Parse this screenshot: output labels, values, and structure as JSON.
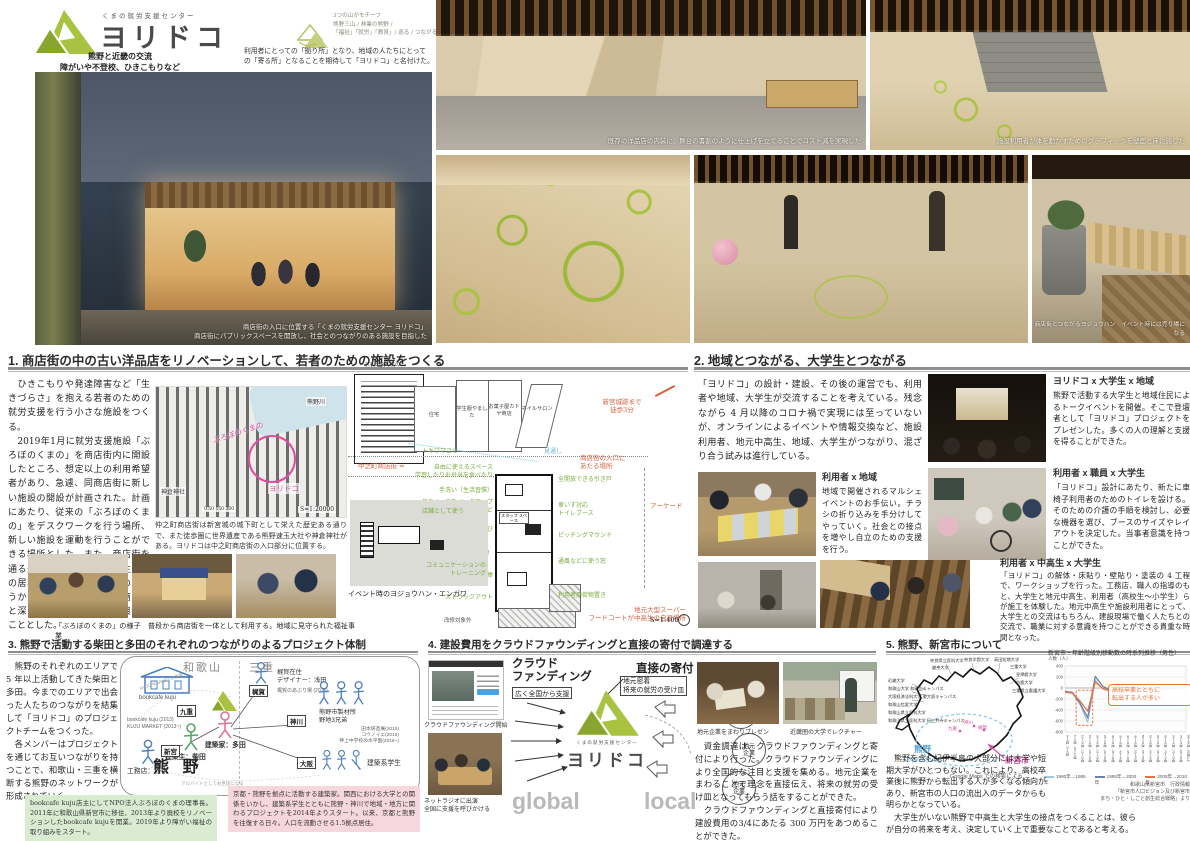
{
  "header": {
    "brand_small": "くまの就労支援センター",
    "brand_title": "ヨリドコ",
    "tagline1": "熊野と近畿の交流",
    "tagline2": "障がいや不登校、ひきこもりなど",
    "tagline3": "“困り感”を抱える若者を支援する場をつくる",
    "motif_title": "3つの山がモチーフ",
    "motif_line1": "熊野三山 / 林業の熊野 /",
    "motif_line2": "「福祉」「就労」「教育」/ 巡る / つながる /",
    "naming_line1": "利用者にとっての「拠り所」となり、地域の人たちにとって",
    "naming_line2": "の「寄る所」となることを期待して「ヨリドコ」と名付けた。"
  },
  "photos": {
    "facade_caption1": "商店街の入口に位置する「くまの就労支援センター ヨリドコ」",
    "facade_caption2": "商店街にパブリックスペースを開放し、社会とのつながりのある施設を目指した",
    "top1_caption": "既存の洋品店の内装に、舞台の書割のように仕上げを立てることでコスト減を実現した",
    "top2_caption": "施設利用者が体を動かすためのグラフィックを壁面と床に施した",
    "row2_caption": "商店街とつながるヨジョウハン　イベント時には売り場になる"
  },
  "section1": {
    "title": "1. 商店街の中の古い洋品店をリノベーションして、若者のための施設をつくる",
    "p1": "　ひきこもりや発達障害など「生きづらさ」を抱える若者のための就労支援を行う小さな施設をつくる。",
    "p2": "　2019年1月に就労支援施設「ぶろぼのくまの」を商店街内に開設したところ、想定以上の利用希望者があり、急遽、同商店街に新しい施設の開設が計画された。計画にあたり、従来の「ぶろぼのくまの」をデスクワークを行う場所、新しい施設を運動を行うことができる場所とした。また、商店街を通る通行客や通学する中高生たちの居場所となること、施設の中をうかがい知ることができる商店街と深く関係を築ける施設を目指すこととした。",
    "map": {
      "river": "熊野川",
      "site1": "ぶろぼのくまの",
      "site2": "ヨリドコ",
      "shrine": "神倉神社",
      "scalebar": "0  50   150     300",
      "scale": "S=1:20000"
    },
    "map_caption": "仲之町商店街は新宮城の城下町として栄えた歴史ある通りで、また徒歩圏に世界遺産である熊野速玉大社や神倉神社がある。ヨリドコは中之町商店街の入口部分に位置する。",
    "photos_caption": "「ぶろぼのくまの」の様子　普段から商店街を一体として利用する。地域に見守られた福祉事業"
  },
  "plan": {
    "bldg0": "ぶろぼのくまの",
    "bldg1": "住宅",
    "bldg2": "学生服やました",
    "bldg3": "お菓子屋カドヤ商店",
    "bldg4": "ネイルサロン",
    "red_castle1": "新宮城跡まで",
    "red_castle2": "徒歩3分",
    "red_street": "中之町商店街",
    "red_entrance1": "商店街の入口に",
    "red_entrance2": "あたる場所",
    "red_arcade": "アーケード",
    "red_super1": "地元大型スーパー",
    "red_super2": "フードコートが中高生の自習場所",
    "blue_sight": "見通し",
    "g_tokiwa": "トキワマユミ",
    "g_free1": "自由に使えるスペース",
    "g_free2": "学習したりお弁当を食べたり",
    "g_wash": "手洗い（生活習慣）",
    "g_backup1": "各スペースをバックアップ",
    "g_backup2": "水回りや冷蔵庫など",
    "g_jump": "垂直跳び",
    "g_kenken": "ケンケンパ！",
    "g_bar": "ぶらさがり棒",
    "g_struck": "ストラックアウト",
    "g_door": "全開放できる引き戸",
    "g_toilet1": "車いす対応",
    "g_toilet2": "トイレブース",
    "g_pitch": "ピッチングマウンド",
    "g_window": "通風などに使う窓",
    "g_bag": "利用者用荷物置き",
    "staff": "スタッフ スペース",
    "off": "改修対象外",
    "inset_use": "店舗として使う",
    "inset_comm1": "コミュニケーションの",
    "inset_comm2": "トレーニング",
    "inset_caption": "イベント時のヨジョウハン・エンガワ",
    "scale": "S=1:400"
  },
  "section2": {
    "title": "2. 地域とつながる、大学生とつながる",
    "intro": "「ヨリドコ」の設計・建設、その後の運営でも、利用者や地域、大学生が交流することを考えている。残念ながら 4 月以降のコロナ禍で実現には至っていないが、オンラインによるイベントや情報交換など、施設利用者、地元中高生、地域、大学生がつながり、混ざり合う試みは進行している。",
    "b1_head": "利用者 x 地域",
    "b1_text": "地域で開催されるマルシェイベントのお手伝い。チラシの折り込みを手分けしてやっていく。社会との接点を増やし自立のための支援を行う。",
    "b2_head": "ヨリドコ x 大学生 x 地域",
    "b2_text": "熊野で活動する大学生と地域住民によるトークイベントを開催。そこで登壇者として「ヨリドコ」プロジェクトをプレゼンした。多くの人の理解と支援を得ることができた。",
    "b3_head": "利用者 x 職員 x 大学生",
    "b3_text": "「ヨリドコ」設計にあたり、新たに車椅子利用者のためのトイレを設ける。そのための介護の手順を検討し、必要な機器を選び、ブースのサイズやレイアウトを決定した。当事者意識を持つことができた。",
    "b4_head": "利用者 x 中高生 x 大学生",
    "b4_text": "「ヨリドコ」の解体・床貼り・壁貼り・塗装の 4 工程で、ワークショップを行った。工務店、職人の指導のもと、大学生と地元中高生、利用者（高校生〜小学生）らが施工を体験した。地元中高生や施設利用者にとって、大学生との交流はもちろん、建設現場で働く人たちとの交流で、職業に対する意識を持つことができる貴重な時間となった。"
  },
  "section3": {
    "title": "3. 熊野で活動する柴田と多田のそれぞれのつながりのよるプロジェクト体制",
    "p1": "　熊野のそれぞれのエリアで 5 年以上活動してきた柴田と多田。今までのエリアで出会った人たちのつながりを結集して「ヨリドコ」のプロジェクトチームをつくった。",
    "p2": "　各メンバーはプロジェクトを通じてお互いつながりを持つことで、和歌山・三重を横断する熊野のネットワークが形成されていく。",
    "region1": "和歌山",
    "region2": "三重",
    "kumano": "熊 野",
    "bookcafe": "bookcafe kuju",
    "kuju": "九重",
    "kuju_note1": "bookcafe kuju (2013)",
    "kuju_note2": "KUJU MARKET (2013~)",
    "shingu": "新宮",
    "koumuten": "工務店：野中",
    "shibata": "建築主：柴田",
    "tada": "建築家：多田",
    "kajika": "梶賀",
    "kajika_l1": "梶賀在住",
    "kajika_l2": "デザイナー：浅田",
    "kajika_note": "梶賀のあぶり場 (2018)",
    "kamikawa": "神川",
    "seizai1": "熊野市製材所",
    "seizai2": "野地3兄弟",
    "kamikawa_n1": "田本研造展(2015)",
    "kamikawa_n2": "コウノイエ(2016)",
    "kamikawa_n3": "神上中学校の水平面(2018~)",
    "osaka": "大阪",
    "students": "建築系学生",
    "link_note1": "KUJU MARKETの支援",
    "link_note2": "アルバイトとしてお世話になる",
    "bio_shibata": "bookcafe kuju店主にしてNPO法人ぶろぼのくまの理事長。2011年に和歌山県新宮市に移住、2013年より廃校をリノベーションしたbookcafe kujuを開業。2019年より障がい福祉の取り組みをスタート。",
    "bio_tada": "京都・熊野を拠点に活動する建築家。関西における大学との関係をいかし、建築系学生とともに熊野・神川で地域・地方に関わるプロジェクトを2014年よりスタート。以来、京都と熊野を往復する日々。人口を流動させる1.5拠点居住。"
  },
  "section4": {
    "title": "4. 建設費用をクラウドファウンディングと直接の寄付で調達する",
    "cf_head1": "クラウド",
    "cf_head2": "ファンディング",
    "cf_box": "広く全国から支援",
    "direct_head": "直接の寄付",
    "direct_box1": "地元密着",
    "direct_box2": "将来の就労の受け皿",
    "company1": "地元",
    "company2": "企業",
    "global_word": "global",
    "local_word": "local",
    "logo_small": "くまの就労支援センター",
    "logo_name": "ヨリドコ",
    "cap_cf": "クラウドファウンディング開始",
    "cap_radio1": "ネットラジオに出演",
    "cap_radio2": "全国に支援を呼びかける",
    "cap_presen": "地元企業をまわりプレゼン",
    "cap_lecture": "近畿圏の大学でレクチャー",
    "p1": "　資金調達は、クラウドファウンディングと寄付により行った。クラウドファウンディングにより全国的な注目と支援を集める。地元企業をまわることで理念を直接伝え、将来の就労の受け皿となってもらう話をすることができた。",
    "p2": "　クラウドファウンディングと直接寄付により建設費用の3/4にあたる 300 万円をあつめることができた。"
  },
  "section5": {
    "title": "5. 熊野、新宮市について",
    "universities": [
      "近畿大学",
      "和歌山大学 和歌山キャンパス",
      "大阪経済法科大学 東大阪キャンパス",
      "和歌山信愛大学",
      "和歌山県立医科大学",
      "和歌山県立医科大学 紀三井寺キャンパス",
      "奈良県立医科大学",
      "畿央大学",
      "奈良学園大学",
      "高田短期大学",
      "三重大学",
      "皇學館大学",
      "鈴鹿大学",
      "三重県立看護大学"
    ],
    "towns": [
      "九重",
      "神川",
      "梶賀"
    ],
    "kumano_label": "熊野",
    "no_univ": "大学がない !?",
    "shingu_label": "新宮市",
    "map_source": "Google Maps での検索による",
    "p1": "　熊野を含む紀伊半島の大部分には大学や短期大学がひとつもない。これにより、高校卒業後に熊野から転出する人が多くなる傾向があり、新宮市の人口の流出入のデータからも明らかとなっている。",
    "p2": "　大学生がいない熊野で中高生と大学生の接点をつくることは、彼らが自分の将来を考え、決定していく上で重要なことであると考える。",
    "callout1": "高校卒業とともに",
    "callout2": "転出する人が多い",
    "source1": "和歌山県新宮市　行政情報",
    "source2": "「新宮市人口ビジョン及び新宮市",
    "source3": "まち・ひと・しごと創生総合戦略」より"
  },
  "chart_data": {
    "type": "line",
    "title": "新宮市・年齢階級別移動数の時系列推移（男性）",
    "ylabel": "人数（人）",
    "ylim": [
      -800,
      400
    ],
    "yticks": [
      400,
      200,
      0,
      -200,
      -400,
      -600,
      -800
    ],
    "grid": true,
    "legend_position": "bottom",
    "categories": [
      "0〜4歳→5〜9歳",
      "5〜9歳→10〜14歳",
      "10〜14歳→15〜19歳",
      "15〜19歳→20〜24歳",
      "20〜24歳→25〜29歳",
      "25〜29歳→30〜34歳",
      "30〜34歳→35〜39歳",
      "35〜39歳→40〜44歳",
      "40〜44歳→45〜49歳",
      "45〜49歳→50〜54歳",
      "50〜54歳→55〜59歳",
      "55〜59歳→60〜64歳",
      "60〜64歳→65〜69歳",
      "65〜69歳→70〜74歳",
      "70〜74歳→75〜79歳",
      "75〜79歳→80〜84歳",
      "80〜84歳→85歳以上"
    ],
    "series": [
      {
        "name": "1980年→1985年",
        "color": "#9ec6e0",
        "values": [
          -80,
          -100,
          -300,
          -620,
          140,
          -20,
          -60,
          -50,
          -40,
          -30,
          -20,
          -20,
          -20,
          -10,
          -10,
          -10,
          0
        ]
      },
      {
        "name": "1995年→2000年",
        "color": "#6b7fae",
        "values": [
          -60,
          -80,
          -280,
          -540,
          210,
          30,
          -40,
          -30,
          -30,
          -20,
          -20,
          -10,
          -10,
          -10,
          0,
          0,
          0
        ]
      },
      {
        "name": "2005年→2010年",
        "color": "#e8763a",
        "values": [
          -70,
          -90,
          -240,
          -420,
          110,
          -10,
          -50,
          -40,
          -30,
          -30,
          -20,
          -10,
          -10,
          -20,
          -10,
          0,
          0
        ]
      }
    ],
    "annotation": "高校卒業とともに転出する人が多い",
    "annotation_box_categories": [
      2,
      3
    ]
  },
  "colors": {
    "brand_green": "#a9c23f",
    "pink": "#d84f9f",
    "red_note": "#d4603e",
    "green_note": "#7cab3f",
    "blue_note": "#6db6d8",
    "orange": "#e8763a"
  }
}
